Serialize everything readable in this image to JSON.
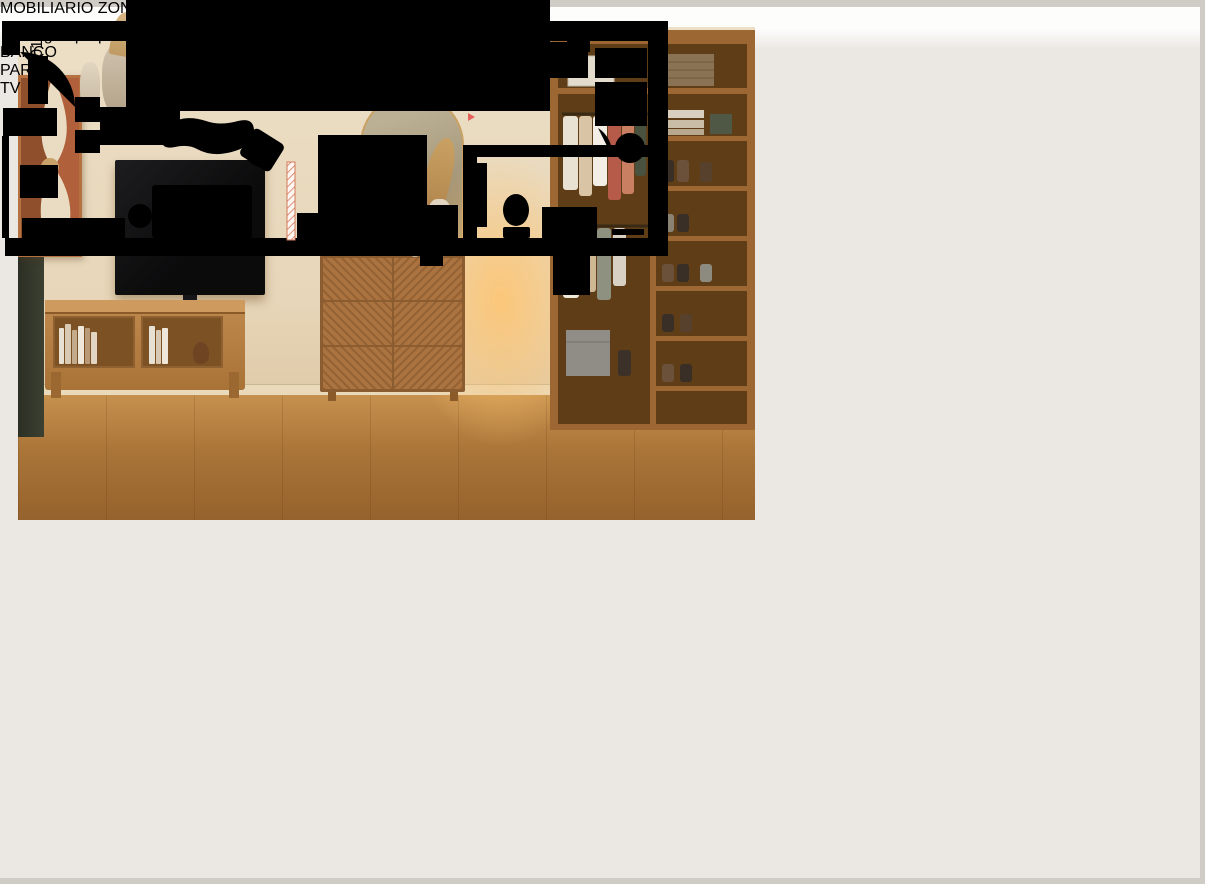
{
  "hero": {
    "title": "ALZADO LATERAL A-1",
    "subtitle": "imagen propuesta aproximada"
  },
  "bench_photo": {
    "label": "BANCO PARA TV"
  },
  "detail_caption": {
    "text": "MOBILIARIO ZONA FRENTE A DORMITORIO Y ESPACIO DE TV."
  },
  "floor_plan": {
    "door_label": "ap 01"
  },
  "colors": {
    "page_bg": "#ebe8e3",
    "accent_terracotta": "#b27c6b",
    "teal": "#2fbfb3",
    "plan_red": "#e4605a",
    "plan_orange": "#d4795a",
    "label_blue": "#5b9bd5"
  }
}
